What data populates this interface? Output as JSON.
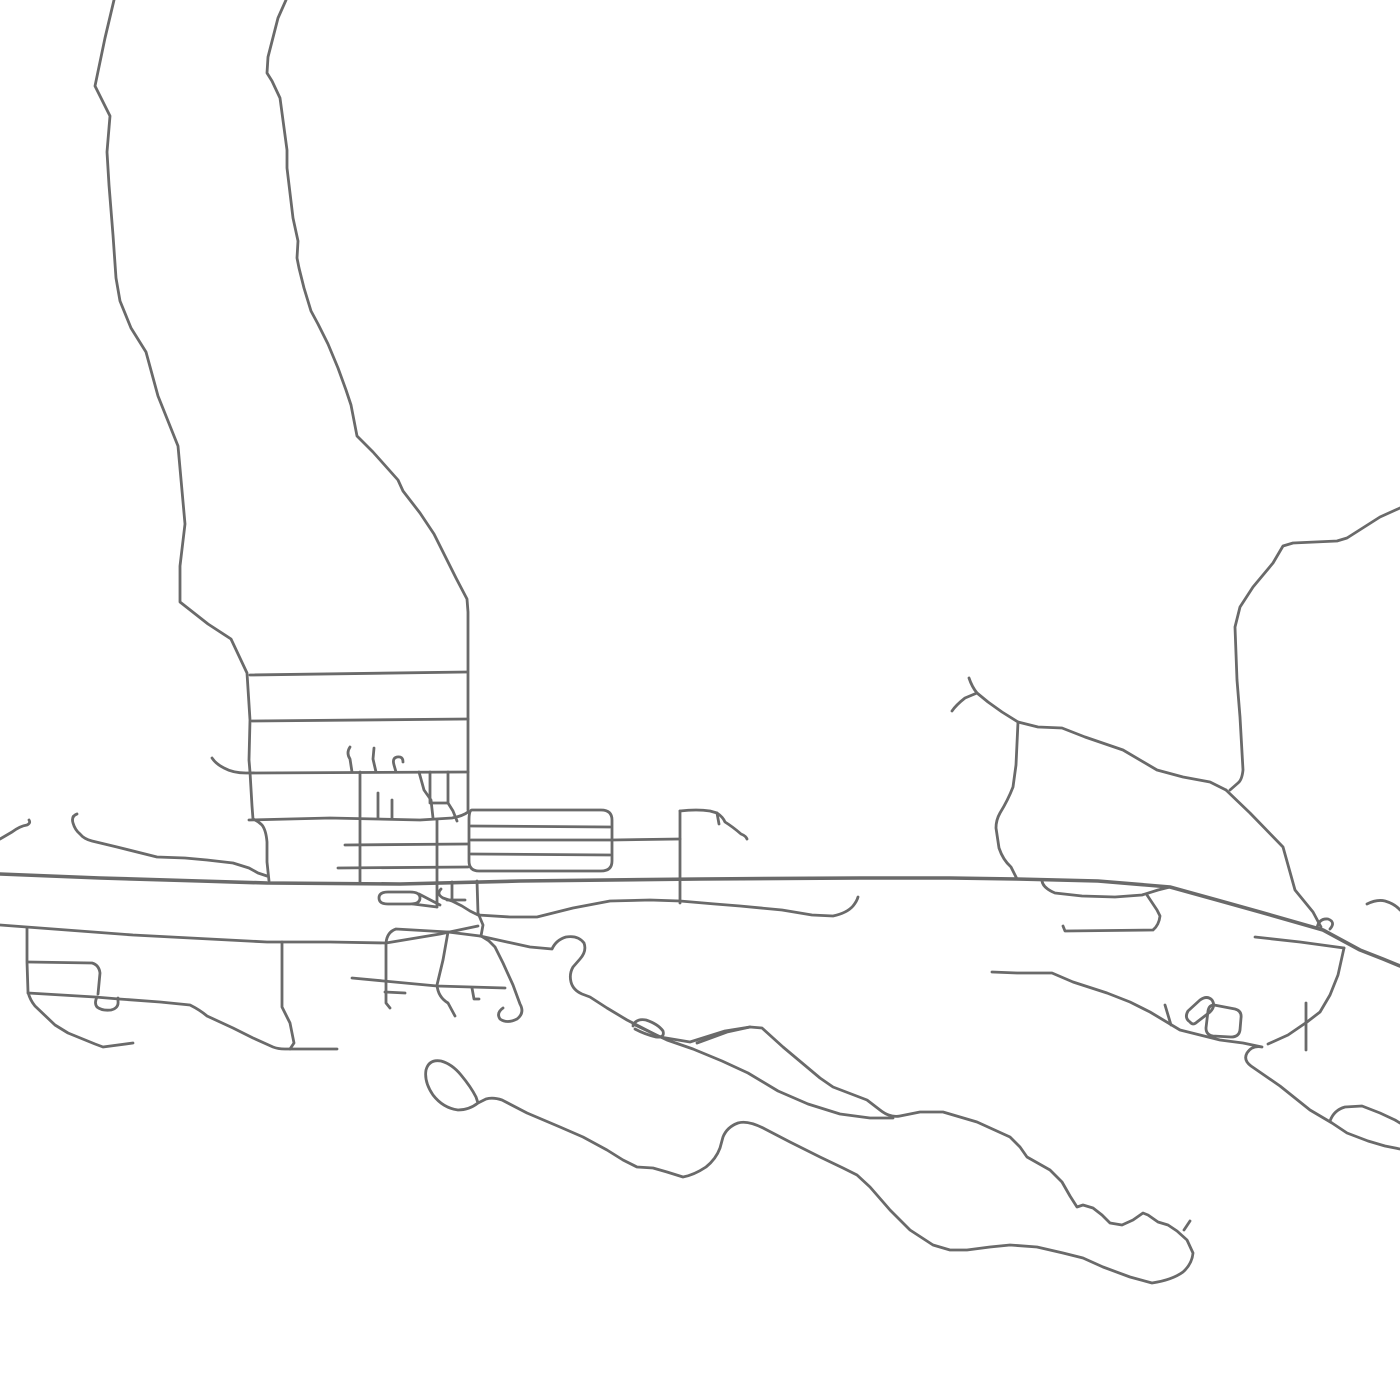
{
  "map": {
    "background_color": "#ffffff",
    "road_color": "#6a6a6a",
    "canvas_width": 1400,
    "canvas_height": 1400,
    "default_stroke_width": 2.8,
    "roads": [
      {
        "id": "road-nw-long",
        "d": "M 114,0 L 105,38 L 95,86 L 110,116 L 107,152 L 109,185 L 113,235 L 116,278 L 120,301 L 131,328 L 146,352 L 158,396 L 178,446 L 185,524 L 180,566 L 180,602 L 208,624 L 231,639 L 247,673 L 250,720 L 249,760 L 250,772 L 252,806 L 253,819 Q 258,821 262,825 Q 266,830 267,842 L 267,862 L 269,881"
      },
      {
        "id": "road-n-long",
        "d": "M 286,0 L 278,18 L 268,57 L 267,73 L 272,81 L 280,98 L 287,150 L 287,168 L 293,218 L 298,241 L 297,258 L 299,268 L 304,288 L 311,311 L 318,324 L 328,344 L 338,368 L 346,390 L 351,405 L 357,436 L 373,452 L 398,480 L 403,491 L 420,513 L 434,534 L 444,554 L 456,578 L 467,599 L 468,612 L 468,810"
      },
      {
        "id": "street-h1",
        "d": "M 250,675 L 467,672"
      },
      {
        "id": "street-h2",
        "d": "M 252,721 L 468,719"
      },
      {
        "id": "street-h3",
        "d": "M 212,758 Q 216,764 224,768 Q 233,773 246,773 L 468,772"
      },
      {
        "id": "street-h4",
        "d": "M 249,820 L 330,818 L 420,820 L 452,818 Q 463,816 468,812"
      },
      {
        "id": "street-h5",
        "d": "M 345,845 L 468,844"
      },
      {
        "id": "street-h6",
        "d": "M 338,868 L 468,867"
      },
      {
        "id": "stub-hook-1",
        "d": "M 350,747 Q 346,753 350,759 L 352,772"
      },
      {
        "id": "stub-hook-2",
        "d": "M 374,748 L 373,759 L 376,772"
      },
      {
        "id": "stub-hook-3",
        "d": "M 403,762 Q 403,756 397,757 Q 392,758 394,765 L 396,772"
      },
      {
        "id": "stub-v1",
        "d": "M 378,793 L 378,818"
      },
      {
        "id": "stub-v2",
        "d": "M 392,800 L 392,818"
      },
      {
        "id": "lane-diagonal",
        "d": "M 419,772 L 424,790 L 431,800 L 433,818"
      },
      {
        "id": "block-small",
        "d": "M 430,772 L 430,803 L 448,803 L 448,772"
      },
      {
        "id": "block-small-tail",
        "d": "M 448,803 L 453,811 L 457,821"
      },
      {
        "id": "stadium-outline",
        "d": "M 472,810 L 601,810 Q 612,810 612,820 L 612,861 Q 612,871 601,871 L 479,871 Q 469,871 469,861 L 469,820 Q 469,810 472,810"
      },
      {
        "id": "stadium-inner-1",
        "d": "M 471,826 L 610,827"
      },
      {
        "id": "stadium-inner-2",
        "d": "M 471,840 L 612,840"
      },
      {
        "id": "stadium-inner-3",
        "d": "M 471,854 L 610,855"
      },
      {
        "id": "road-east-stadium",
        "d": "M 612,840 L 680,839"
      },
      {
        "id": "road-v-680",
        "d": "M 680,811 L 680,903"
      },
      {
        "id": "road-hook-680",
        "d": "M 680,811 Q 697,809 710,811 L 717,813 Q 723,817 725,822 Q 733,827 741,834 Q 746,836 747,839"
      },
      {
        "id": "tick-680",
        "d": "M 717,813 L 719,824"
      },
      {
        "id": "road-main",
        "w": 3.6,
        "d": "M 0,874 L 100,878 L 200,881 L 267,883 L 400,884 L 520,881 L 700,879 L 860,878 L 950,878 L 1017,879 L 1098,881 L 1170,887 L 1217,900 L 1260,912 L 1323,930 L 1360,950 L 1383,959 L 1400,966"
      },
      {
        "id": "road-lower-long",
        "d": "M 0,925 L 133,935 L 267,942 L 330,942 L 386,943 L 440,934 L 478,926"
      },
      {
        "id": "block-left-side",
        "d": "M 386,943 L 386,1003 L 390,1008"
      },
      {
        "id": "block-left-stub",
        "d": "M 385,992 L 405,993"
      },
      {
        "id": "block-top",
        "d": "M 386,943 Q 387,932 396,929 L 448,932 L 480,936"
      },
      {
        "id": "block-right-slant",
        "d": "M 448,932 L 443,960 L 437,985 Q 438,997 448,1003 L 455,1016"
      },
      {
        "id": "cross-street",
        "d": "M 352,978 L 437,986 L 505,988"
      },
      {
        "id": "stub-l",
        "d": "M 472,988 L 474,999 L 479,999"
      },
      {
        "id": "descender",
        "d": "M 477,881 L 478,913 L 483,925 L 481,936 L 489,941 L 495,947 L 503,963 L 513,985 L 520,1004 Q 525,1013 517,1019 Q 507,1024 500,1019 Q 496,1013 503,1008"
      },
      {
        "id": "road-wavy-south",
        "d": "M 441,889 Q 436,894 443,898 L 452,901 L 462,906 L 470,911 L 478,915 L 510,917 L 537,917 L 573,908 L 610,901 L 650,900 L 680,901 L 715,904 L 740,906 L 782,910 L 812,915 L 833,916 Q 847,913 853,906 Q 857,901 858,897"
      },
      {
        "id": "culdesac-pill",
        "d": "M 388,892 L 410,892 Q 420,892 420,898 Q 420,904 410,904 L 388,904 Q 379,904 379,898 Q 379,892 388,892"
      },
      {
        "id": "pill-link-1",
        "d": "M 419,894 L 440,905"
      },
      {
        "id": "pill-link-2",
        "d": "M 413,904 L 437,907"
      },
      {
        "id": "road-v-437",
        "d": "M 437,820 L 437,907"
      },
      {
        "id": "road-v-360",
        "d": "M 360,772 L 360,882"
      },
      {
        "id": "stub-v-452",
        "d": "M 452,882 L 452,899"
      },
      {
        "id": "stub-h-452",
        "d": "M 447,900 L 465,900"
      },
      {
        "id": "loop-fish-whale",
        "d": "M 480,936 L 507,942 L 530,947 L 552,949 Q 556,940 566,937 Q 578,935 584,943 Q 587,951 580,959 L 573,967 Q 569,974 571,982 Q 573,990 582,994 L 590,997 L 607,1008 L 627,1020 L 660,1037 L 690,1042 L 725,1031 L 750,1027 L 762,1028 L 783,1047 L 820,1078 L 833,1087 L 867,1100 L 880,1110 Q 890,1118 900,1116 L 920,1112 L 943,1112 L 977,1122 L 1010,1137 L 1020,1147 L 1027,1157 L 1050,1170 L 1062,1182 L 1070,1196 L 1077,1207 L 1083,1205 L 1093,1208 L 1102,1215 L 1110,1223 L 1122,1225 L 1133,1220 L 1143,1213 L 1148,1215 L 1158,1222 L 1168,1225 L 1177,1231 L 1187,1240 L 1193,1253 Q 1192,1264 1183,1272 Q 1172,1280 1152,1283 L 1130,1277 L 1103,1267 L 1083,1258 L 1063,1253 L 1037,1247 L 1010,1245 L 990,1247 L 967,1250 L 950,1250 L 933,1245 L 910,1230 L 890,1210 L 870,1187 L 857,1175 L 843,1168 L 820,1157 L 790,1142 L 765,1129 Q 748,1120 738,1123 Q 727,1127 723,1137 L 720,1148 Q 716,1159 706,1167 Q 694,1175 683,1177 L 667,1172 L 653,1168 L 637,1167 L 623,1160 L 607,1150 L 583,1137 L 560,1127 L 527,1113 L 502,1100 Q 493,1097 486,1099 L 478,1103 Q 469,1110 458,1110 Q 443,1108 433,1095 Q 424,1082 426,1070 Q 429,1059 441,1061 Q 452,1064 461,1075 Q 471,1087 476,1097 L 478,1103"
      },
      {
        "id": "channel-lower",
        "d": "M 633,1024 L 667,1040 L 693,1049 L 722,1061 L 748,1073 L 778,1091 L 808,1104 L 840,1114 L 870,1118 L 893,1118"
      },
      {
        "id": "channel-upper-tip",
        "d": "M 697,1043 L 727,1032 L 750,1027"
      },
      {
        "id": "bump-pill",
        "d": "M 633,1026 Q 636,1018 646,1020 Q 658,1024 663,1031 Q 665,1038 656,1037 Q 644,1034 635,1029"
      },
      {
        "id": "road-bl-1",
        "d": "M 27,928 L 27,962 L 28,992 Q 30,1000 35,1006 L 55,1025 L 68,1033 L 95,1044 L 103,1047 L 133,1043"
      },
      {
        "id": "road-bl-2",
        "d": "M 28,962 L 92,963 Q 99,965 100,973 L 98,994"
      },
      {
        "id": "road-bl-3",
        "d": "M 28,993 L 95,997 L 119,999 L 160,1002 L 190,1005 Q 200,1010 207,1016 L 233,1028 L 253,1038 L 273,1047 Q 278,1049 285,1049 L 337,1049"
      },
      {
        "id": "pouch",
        "d": "M 97,997 Q 94,1003 97,1007 Q 102,1011 111,1010 Q 119,1008 118,1001 L 118,998"
      },
      {
        "id": "road-bl-4",
        "d": "M 282,942 L 282,1007 L 290,1023 L 294,1043 L 290,1049"
      },
      {
        "id": "road-west-wavy",
        "d": "M 77,814 Q 71,816 73,823 Q 75,830 80,834 Q 84,839 92,841 L 117,847 L 157,857 L 185,858 L 207,860 L 233,863 L 249,868 L 258,873 L 267,876"
      },
      {
        "id": "road-left-hook",
        "d": "M 0,839 L 12,832 Q 20,826 27,825 Q 31,823 29,820"
      },
      {
        "id": "fork-road",
        "d": "M 969,678 Q 972,687 977,693 L 988,702 L 1002,712 L 1018,722 L 1038,727 L 1062,728 L 1085,737 L 1123,750 L 1157,770 L 1183,777 L 1210,782 L 1226,790"
      },
      {
        "id": "fork-tip",
        "d": "M 952,711 Q 956,705 965,698 L 977,693"
      },
      {
        "id": "fork-south",
        "d": "M 1018,722 L 1016,765 L 1013,787 Q 1008,800 1000,813 Q 996,820 996,828 L 999,848 Q 1003,860 1011,867 L 1017,879"
      },
      {
        "id": "road-ne-curve",
        "d": "M 1400,508 L 1380,517 L 1347,538 L 1337,541 L 1293,543 L 1283,546 L 1273,563 L 1253,587 L 1240,607 L 1235,627 L 1237,680 L 1240,717 L 1243,770 Q 1242,780 1238,783 L 1230,790"
      },
      {
        "id": "road-diag-se",
        "d": "M 1226,790 L 1250,813 L 1283,847 L 1295,890 L 1313,912 L 1321,927"
      },
      {
        "id": "loop-smile",
        "d": "M 1042,881 Q 1043,888 1055,893 L 1082,896 L 1115,897 L 1142,895 L 1158,890 L 1170,887"
      },
      {
        "id": "smile-stub",
        "d": "M 1147,895 L 1157,910 L 1160,916 Q 1159,925 1153,930 L 1065,931 L 1063,926"
      },
      {
        "id": "road-e-horiz",
        "d": "M 1255,937 L 1300,942 L 1344,948"
      },
      {
        "id": "road-e-desc",
        "d": "M 1344,948 L 1338,975 L 1330,995 L 1320,1012 L 1307,1022 L 1288,1035 L 1268,1044"
      },
      {
        "id": "stub-e",
        "d": "M 1306,1003 L 1306,1050"
      },
      {
        "id": "road-se-wavy",
        "d": "M 992,972 L 1017,973 L 1052,973 L 1073,982 L 1107,993 L 1130,1002 L 1150,1012 L 1180,1030 L 1220,1040 L 1243,1043 L 1262,1047 Q 1252,1045 1247,1053 Q 1243,1060 1251,1066 L 1280,1086 L 1310,1110 L 1332,1123 L 1347,1133 L 1368,1141 L 1385,1146 L 1400,1149"
      },
      {
        "id": "tick-se",
        "d": "M 1165,1005 L 1171,1025"
      },
      {
        "id": "road-switchback",
        "d": "M 1330,1121 Q 1334,1110 1345,1107 L 1362,1106 L 1380,1113 L 1395,1120 L 1400,1123"
      },
      {
        "id": "hook-ne-small",
        "d": "M 1367,904 Q 1377,899 1385,901 Q 1395,904 1400,910"
      },
      {
        "id": "pill-e-1",
        "d": "M 1190,1022 Q 1184,1018 1188,1011 L 1200,1000 Q 1207,995 1212,1000 Q 1216,1006 1210,1012 L 1197,1022 Q 1193,1026 1190,1022"
      },
      {
        "id": "pill-e-2",
        "d": "M 1214,1005 L 1235,1009 Q 1242,1011 1241,1018 L 1240,1030 Q 1239,1037 1231,1037 L 1213,1036 Q 1206,1035 1206,1028 L 1208,1011 Q 1209,1005 1214,1005"
      },
      {
        "id": "squiggle-main",
        "d": "M 1317,928 Q 1319,918 1328,919 Q 1336,922 1330,929"
      },
      {
        "id": "tick-whale",
        "d": "M 1184,1230 L 1190,1221"
      }
    ]
  }
}
